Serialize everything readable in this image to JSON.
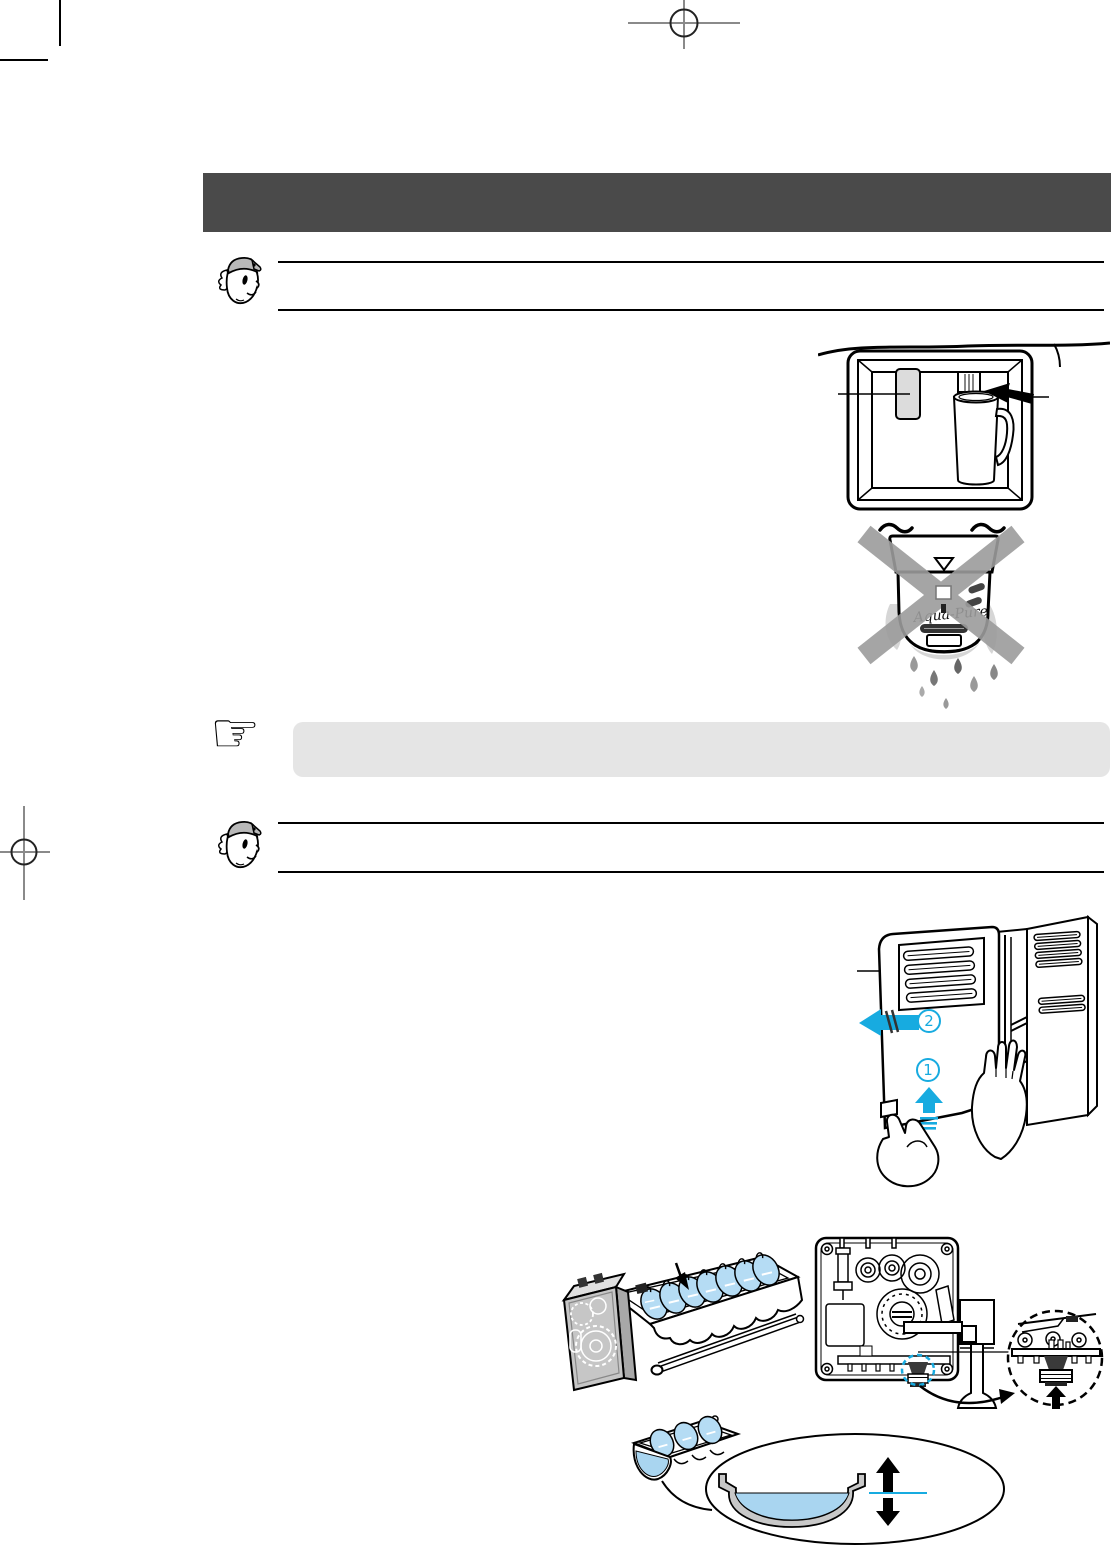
{
  "colors": {
    "header_bar": "#4a4a4a",
    "accent_cyan": "#17abe0",
    "ice_blue": "#b5dcf4",
    "water_blue": "#a9d5f0",
    "note_box_bg": "#e5e5e5",
    "prohibit_gray": "#9c9c9c",
    "metal_gray": "#c6c6c6",
    "cap_gray": "#b9b9b9",
    "splash_gray": "#d6d6d6",
    "rim_gray": "#c8c8c8"
  },
  "header": {
    "visible_text": ""
  },
  "tips": [
    {
      "icon": "mascot-face-icon"
    },
    {
      "icon": "mascot-face-icon"
    }
  ],
  "note": {
    "icon": "pointing-hand-icon",
    "glyph": "☞",
    "visible_text": ""
  },
  "illustrations": {
    "water_dispenser": {
      "name": "water-dispenser-cup-press"
    },
    "water_filter": {
      "name": "water-filter-leak-prohibited",
      "brand_label": "Aqua-Pure"
    },
    "cover_removal": {
      "name": "ice-maker-cover-removal",
      "steps": [
        {
          "label": "1"
        },
        {
          "label": "2"
        }
      ]
    },
    "ice_maker": {
      "name": "ice-maker-assembly"
    },
    "mechanism": {
      "name": "ice-maker-drive-mechanism"
    },
    "water_level": {
      "name": "ice-tray-water-level-adjustment"
    }
  }
}
